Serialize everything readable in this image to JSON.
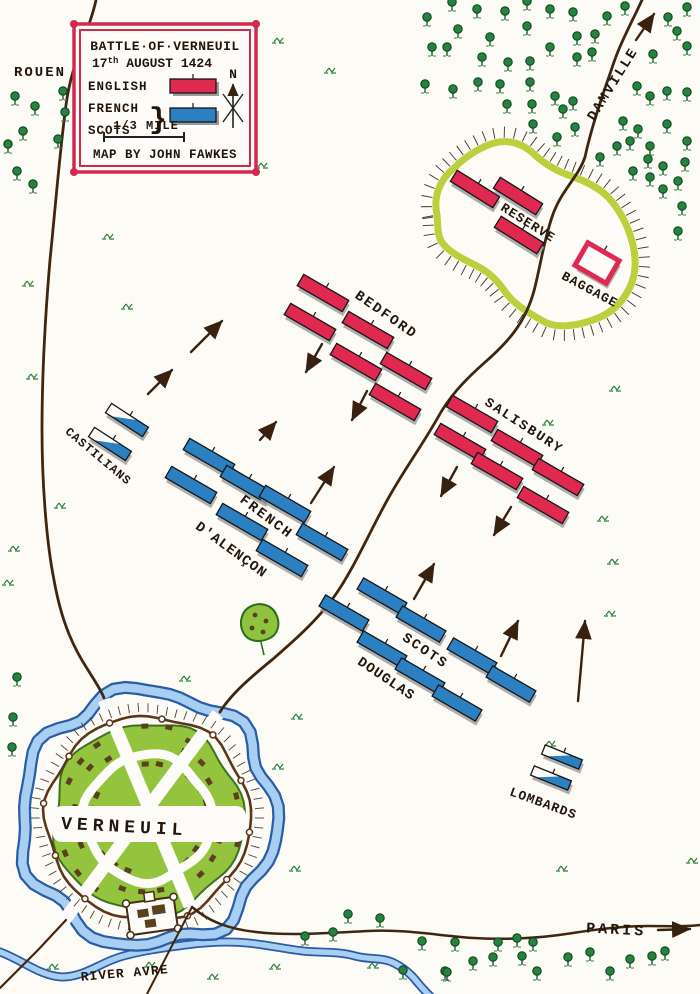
{
  "colors": {
    "paper": "#fcfbf6",
    "ink": "#221509",
    "road": "#40260f",
    "english": "#df2950",
    "french": "#2b80c2",
    "shadow": "#9b9b9b",
    "river_dark": "#2b5ca6",
    "river_light": "#a8cff2",
    "tree": "#27813f",
    "tree_dark": "#0c4a20",
    "tuft": "#2e8040",
    "enclosure": "#b6cd31",
    "town_green": "#94c43e",
    "house": "#5b4020",
    "wall": "#5a371b",
    "hachure": "#4a4238",
    "legend_red": "#d22a4e"
  },
  "title_box": {
    "title": "BATTLE·OF·VERNEUIL",
    "date_num": "17",
    "date_sup": "th",
    "date_rest": " AUGUST 1424",
    "legend_english": "ENGLISH",
    "legend_french": "FRENCH",
    "legend_scots": "SCOTS",
    "legend_brace": "}",
    "north_label": "N",
    "scale_label": "1/3 MILE",
    "credit": "MAP BY JOHN FAWKES"
  },
  "map_data": {
    "labels": [
      {
        "text": "ROUEN",
        "x": 40,
        "y": 76,
        "rot": 0,
        "size": 14,
        "ls": 2
      },
      {
        "text": "DAMVILLE",
        "x": 616,
        "y": 86,
        "rot": -58,
        "size": 14,
        "ls": 2
      },
      {
        "text": "RESERVE",
        "x": 526,
        "y": 226,
        "rot": 32,
        "size": 13,
        "ls": 1
      },
      {
        "text": "BAGGAGE",
        "x": 588,
        "y": 293,
        "rot": 28,
        "size": 13,
        "ls": 1
      },
      {
        "text": "BEDFORD",
        "x": 384,
        "y": 318,
        "rot": 35,
        "size": 14,
        "ls": 2
      },
      {
        "text": "SALISBURY",
        "x": 522,
        "y": 429,
        "rot": 33,
        "size": 13.5,
        "ls": 2
      },
      {
        "text": "CASTILIANS",
        "x": 96,
        "y": 459,
        "rot": 40,
        "size": 12,
        "ls": 1
      },
      {
        "text": "FRENCH",
        "x": 264,
        "y": 520,
        "rot": 37,
        "size": 14,
        "ls": 2
      },
      {
        "text": "D'ALENÇON",
        "x": 229,
        "y": 553,
        "rot": 36,
        "size": 14,
        "ls": 1
      },
      {
        "text": "SCOTS",
        "x": 423,
        "y": 654,
        "rot": 34,
        "size": 14,
        "ls": 2
      },
      {
        "text": "DOUGLAS",
        "x": 384,
        "y": 682,
        "rot": 34,
        "size": 14,
        "ls": 1
      },
      {
        "text": "LOMBARDS",
        "x": 542,
        "y": 807,
        "rot": 20,
        "size": 13,
        "ls": 1
      },
      {
        "text": "VERNEUIL",
        "x": 124,
        "y": 832,
        "rot": 3,
        "size": 18,
        "ls": 5
      },
      {
        "text": "PARIS",
        "x": 616,
        "y": 934,
        "rot": 3,
        "size": 15,
        "ls": 3
      },
      {
        "text": "RIVER AVRE",
        "x": 125,
        "y": 977,
        "rot": -5,
        "size": 13,
        "ls": 1
      }
    ],
    "unit_groups": [
      {
        "name": "RESERVE",
        "side": "english",
        "rot": 32,
        "len": 50,
        "h": 13,
        "blocks": [
          [
            475,
            189
          ],
          [
            518,
            196
          ],
          [
            519,
            235
          ]
        ]
      },
      {
        "name": "BEDFORD",
        "side": "english",
        "rot": 30,
        "len": 52,
        "h": 13,
        "blocks": [
          [
            323,
            293
          ],
          [
            310,
            322
          ],
          [
            368,
            330
          ],
          [
            356,
            362
          ],
          [
            406,
            371
          ],
          [
            395,
            402
          ]
        ]
      },
      {
        "name": "SALISBURY",
        "side": "english",
        "rot": 30,
        "len": 52,
        "h": 13,
        "blocks": [
          [
            472,
            414
          ],
          [
            460,
            442
          ],
          [
            517,
            448
          ],
          [
            497,
            471
          ],
          [
            558,
            477
          ],
          [
            543,
            505
          ]
        ]
      },
      {
        "name": "CASTILIANS",
        "side": "mixed",
        "rot": 33,
        "len": 44,
        "h": 11,
        "blocks": [
          [
            127,
            420
          ],
          [
            110,
            444
          ]
        ]
      },
      {
        "name": "FRENCH D'ALENCON",
        "side": "french",
        "rot": 30,
        "len": 52,
        "h": 13,
        "blocks": [
          [
            209,
            457
          ],
          [
            191,
            485
          ],
          [
            246,
            484
          ],
          [
            285,
            504
          ],
          [
            242,
            522
          ],
          [
            322,
            542
          ],
          [
            282,
            558
          ]
        ]
      },
      {
        "name": "SCOTS DOUGLAS",
        "side": "french",
        "rot": 30,
        "len": 50,
        "h": 13,
        "blocks": [
          [
            382,
            596
          ],
          [
            344,
            613
          ],
          [
            421,
            624
          ],
          [
            382,
            649
          ],
          [
            472,
            656
          ],
          [
            420,
            676
          ],
          [
            511,
            684
          ],
          [
            457,
            703
          ]
        ]
      },
      {
        "name": "LOMBARDS",
        "side": "mixed",
        "rot": 22,
        "len": 40,
        "h": 10,
        "blocks": [
          [
            562,
            757
          ],
          [
            551,
            778
          ]
        ]
      }
    ],
    "baggage": {
      "x": 597,
      "y": 263,
      "rot": 30,
      "w": 36,
      "h": 26
    },
    "arrows": [
      [
        636,
        40,
        654,
        14
      ],
      [
        322,
        344,
        306,
        372
      ],
      [
        367,
        391,
        352,
        420
      ],
      [
        457,
        467,
        441,
        496
      ],
      [
        511,
        507,
        494,
        535
      ],
      [
        191,
        352,
        222,
        321
      ],
      [
        148,
        394,
        172,
        370
      ],
      [
        260,
        440,
        276,
        422
      ],
      [
        311,
        503,
        334,
        467
      ],
      [
        414,
        599,
        434,
        564
      ],
      [
        501,
        656,
        518,
        621
      ],
      [
        578,
        701,
        585,
        621
      ],
      [
        658,
        930,
        690,
        929
      ]
    ],
    "trees": [
      [
        15,
        102
      ],
      [
        35,
        112
      ],
      [
        63,
        97
      ],
      [
        65,
        118
      ],
      [
        23,
        137
      ],
      [
        58,
        145
      ],
      [
        8,
        150
      ],
      [
        17,
        177
      ],
      [
        33,
        190
      ],
      [
        17,
        683
      ],
      [
        13,
        723
      ],
      [
        12,
        753
      ],
      [
        452,
        8
      ],
      [
        477,
        15
      ],
      [
        505,
        17
      ],
      [
        527,
        7
      ],
      [
        550,
        15
      ],
      [
        573,
        18
      ],
      [
        607,
        22
      ],
      [
        625,
        12
      ],
      [
        668,
        23
      ],
      [
        687,
        13
      ],
      [
        427,
        23
      ],
      [
        458,
        35
      ],
      [
        490,
        43
      ],
      [
        527,
        32
      ],
      [
        577,
        42
      ],
      [
        595,
        40
      ],
      [
        677,
        37
      ],
      [
        687,
        52
      ],
      [
        432,
        53
      ],
      [
        447,
        53
      ],
      [
        482,
        63
      ],
      [
        508,
        68
      ],
      [
        530,
        67
      ],
      [
        550,
        53
      ],
      [
        577,
        63
      ],
      [
        592,
        58
      ],
      [
        653,
        60
      ],
      [
        425,
        90
      ],
      [
        453,
        95
      ],
      [
        478,
        88
      ],
      [
        500,
        90
      ],
      [
        530,
        88
      ],
      [
        555,
        102
      ],
      [
        573,
        107
      ],
      [
        637,
        92
      ],
      [
        650,
        102
      ],
      [
        667,
        97
      ],
      [
        687,
        98
      ],
      [
        507,
        110
      ],
      [
        532,
        110
      ],
      [
        563,
        115
      ],
      [
        533,
        130
      ],
      [
        557,
        143
      ],
      [
        575,
        133
      ],
      [
        623,
        127
      ],
      [
        638,
        135
      ],
      [
        667,
        130
      ],
      [
        687,
        147
      ],
      [
        650,
        152
      ],
      [
        630,
        147
      ],
      [
        617,
        152
      ],
      [
        600,
        163
      ],
      [
        648,
        165
      ],
      [
        663,
        172
      ],
      [
        685,
        168
      ],
      [
        633,
        177
      ],
      [
        650,
        183
      ],
      [
        663,
        195
      ],
      [
        678,
        187
      ],
      [
        682,
        212
      ],
      [
        678,
        237
      ],
      [
        348,
        920
      ],
      [
        380,
        924
      ],
      [
        305,
        942
      ],
      [
        333,
        938
      ],
      [
        403,
        976
      ],
      [
        422,
        947
      ],
      [
        445,
        977
      ],
      [
        455,
        948
      ],
      [
        473,
        967
      ],
      [
        493,
        963
      ],
      [
        498,
        948
      ],
      [
        517,
        944
      ],
      [
        522,
        962
      ],
      [
        533,
        948
      ],
      [
        537,
        977
      ],
      [
        568,
        963
      ],
      [
        590,
        958
      ],
      [
        610,
        977
      ],
      [
        630,
        965
      ],
      [
        652,
        962
      ],
      [
        665,
        957
      ],
      [
        447,
        978
      ]
    ],
    "tufts": [
      [
        278,
        42
      ],
      [
        330,
        72
      ],
      [
        262,
        167
      ],
      [
        108,
        238
      ],
      [
        28,
        285
      ],
      [
        127,
        308
      ],
      [
        32,
        378
      ],
      [
        60,
        507
      ],
      [
        14,
        550
      ],
      [
        8,
        584
      ],
      [
        615,
        390
      ],
      [
        603,
        520
      ],
      [
        548,
        424
      ],
      [
        613,
        563
      ],
      [
        562,
        870
      ],
      [
        692,
        862
      ],
      [
        295,
        870
      ],
      [
        53,
        968
      ],
      [
        150,
        966
      ],
      [
        213,
        978
      ],
      [
        275,
        968
      ],
      [
        373,
        967
      ],
      [
        297,
        718
      ],
      [
        278,
        768
      ],
      [
        185,
        680
      ],
      [
        550,
        745
      ],
      [
        610,
        615
      ]
    ]
  }
}
